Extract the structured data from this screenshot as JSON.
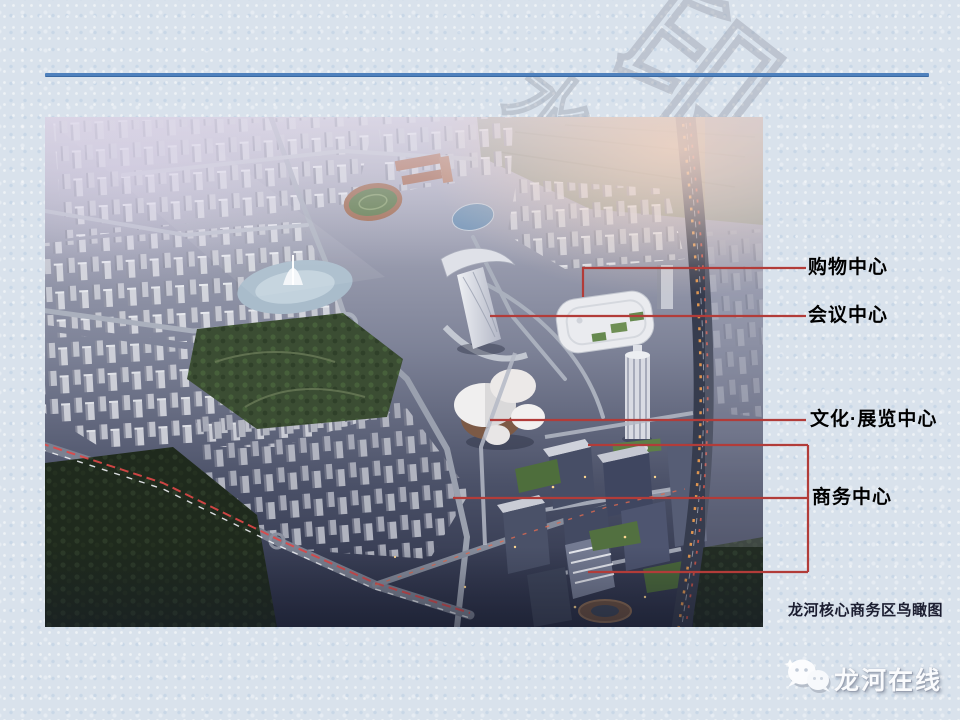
{
  "decor": {
    "accent_rule_color": "#4f81bd",
    "leader_line_color": "#b23c39",
    "background_color": "#d9e2ec",
    "watermark_char_main": "印",
    "watermark_char_partial": "水"
  },
  "photo": {
    "type": "aerial-rendering",
    "subject": "龙河核心商务区鸟瞰图"
  },
  "callouts": {
    "shopping": "购物中心",
    "conference": "会议中心",
    "culture": "文化·展览中心",
    "business": "商务中心"
  },
  "caption": "龙河核心商务区鸟瞰图",
  "logo": {
    "label": "龙河在线",
    "icon": "chat-bubbles-icon"
  }
}
